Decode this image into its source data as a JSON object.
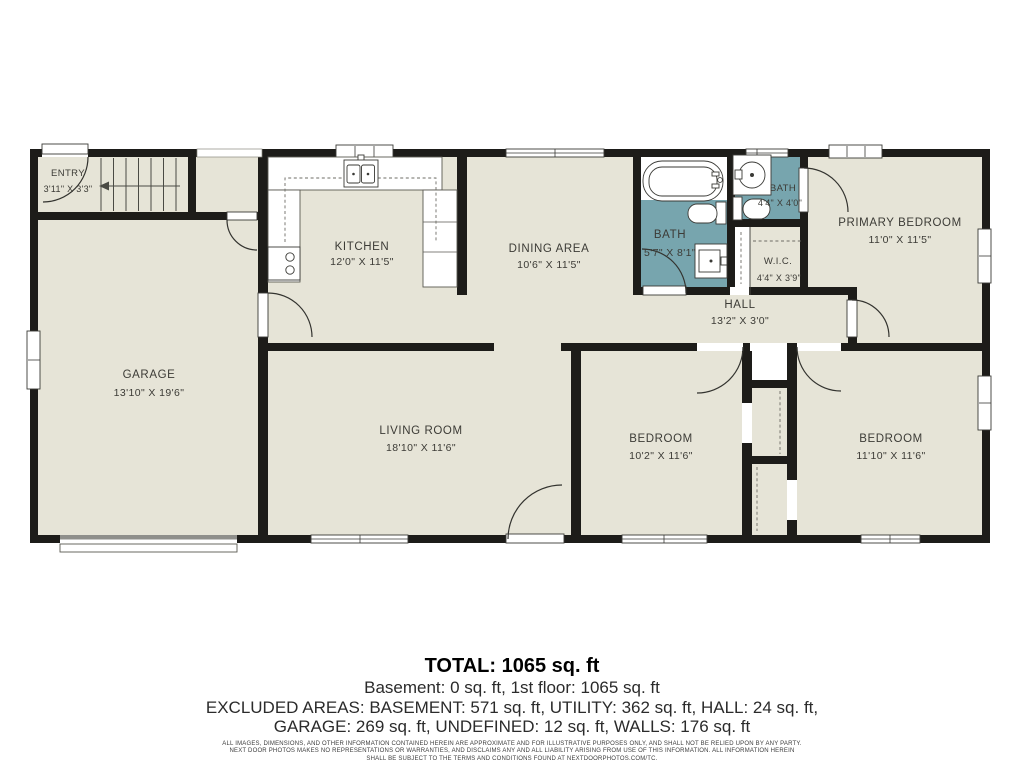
{
  "colors": {
    "wall": "#1d1c19",
    "floor": "#e6e4d7",
    "bath_floor": "#77a5ae",
    "page": "#ffffff"
  },
  "rooms": {
    "entry": {
      "name": "ENTRY",
      "dims": "3'11\" X 3'3\""
    },
    "kitchen": {
      "name": "KITCHEN",
      "dims": "12'0\" X 11'5\""
    },
    "dining": {
      "name": "DINING AREA",
      "dims": "10'6\" X 11'5\""
    },
    "bath_main": {
      "name": "BATH",
      "dims": "5'7\" X 8'1\""
    },
    "bath_ensuite": {
      "name": "BATH",
      "dims": "4'4\" X 4'0\""
    },
    "wic": {
      "name": "W.I.C.",
      "dims": "4'4\" X 3'9\""
    },
    "primary_bedroom": {
      "name": "PRIMARY BEDROOM",
      "dims": "11'0\" X 11'5\""
    },
    "hall": {
      "name": "HALL",
      "dims": "13'2\" X 3'0\""
    },
    "garage": {
      "name": "GARAGE",
      "dims": "13'10\" X 19'6\""
    },
    "living_room": {
      "name": "LIVING ROOM",
      "dims": "18'10\" X 11'6\""
    },
    "bedroom_left": {
      "name": "BEDROOM",
      "dims": "10'2\" X 11'6\""
    },
    "bedroom_right": {
      "name": "BEDROOM",
      "dims": "11'10\" X 11'6\""
    }
  },
  "summary": {
    "total": "TOTAL: 1065 sq. ft",
    "floors": "Basement: 0 sq. ft, 1st floor: 1065 sq. ft",
    "excluded_1": "EXCLUDED AREAS: BASEMENT: 571 sq. ft, UTILITY: 362 sq. ft, HALL: 24 sq. ft,",
    "excluded_2": "GARAGE: 269 sq. ft, UNDEFINED: 12 sq. ft, WALLS: 176 sq. ft"
  },
  "disclaimer": {
    "line1": "ALL IMAGES, DIMENSIONS, AND OTHER INFORMATION CONTAINED HEREIN ARE APPROXIMATE AND FOR ILLUSTRATIVE PURPOSES ONLY, AND SHALL NOT BE RELIED UPON BY ANY PARTY.",
    "line2": "NEXT DOOR PHOTOS MAKES NO REPRESENTATIONS OR WARRANTIES, AND DISCLAIMS ANY AND ALL LIABILITY ARISING FROM USE OF THIS INFORMATION. ALL INFORMATION HEREIN",
    "line3": "SHALL BE SUBJECT TO THE TERMS AND CONDITIONS FOUND AT NEXTDOORPHOTOS.COM/TC."
  }
}
